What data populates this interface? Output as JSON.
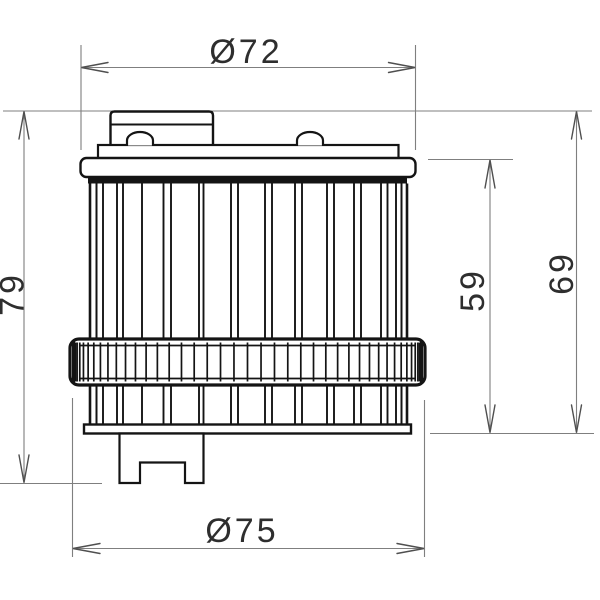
{
  "drawing": {
    "type": "technical-drawing",
    "subject": "cylindrical filter element, front elevation with dimensions",
    "units_shown": "mm (implied)",
    "dimensions": {
      "top_diameter": {
        "label": "Ø72",
        "value": 72,
        "kind": "diameter",
        "measures": "top flange diameter"
      },
      "bottom_diameter": {
        "label": "Ø75",
        "value": 75,
        "kind": "diameter",
        "measures": "knurled band diameter"
      },
      "overall_height": {
        "label": "79",
        "value": 79,
        "kind": "linear",
        "measures": "cap top to bottom fitting"
      },
      "flange_height": {
        "label": "59",
        "value": 59,
        "kind": "linear",
        "measures": "flange top to bottom plate"
      },
      "cap_height": {
        "label": "69",
        "value": 69,
        "kind": "linear",
        "measures": "cap top to bottom plate"
      }
    },
    "colors": {
      "ink": "#141414",
      "dim_line": "#7f7f7f",
      "arrow": "#4f4f4f",
      "text": "#2e2e2e",
      "background": "#ffffff"
    }
  }
}
